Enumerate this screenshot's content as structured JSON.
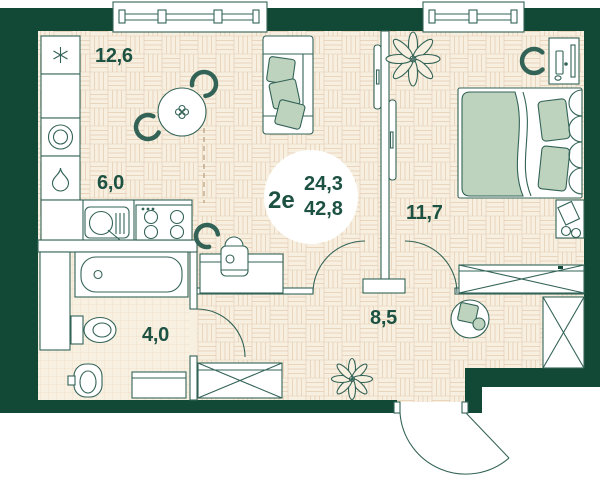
{
  "plan": {
    "badge": {
      "type_label": "2е",
      "area_living": "24,3",
      "area_total": "42,8"
    },
    "rooms": {
      "living_dining": {
        "label": "12,6"
      },
      "kitchen": {
        "label": "6,0"
      },
      "bathroom": {
        "label": "4,0"
      },
      "hallway": {
        "label": "8,5"
      },
      "bedroom": {
        "label": "11,7"
      }
    },
    "icons": {
      "fridge": "snowflake-icon",
      "water_heater": "drop-icon",
      "washing_machine": "circle-drum-icon"
    },
    "colors": {
      "wall": "#114936",
      "outline": "#336357",
      "accent_sage": "#bdd3bd",
      "floor": "#f7f0e0",
      "pattern_line": "#e8d2ba",
      "tile_line": "#eedbc4",
      "text": "#1d5142",
      "background": "#ffffff"
    }
  }
}
